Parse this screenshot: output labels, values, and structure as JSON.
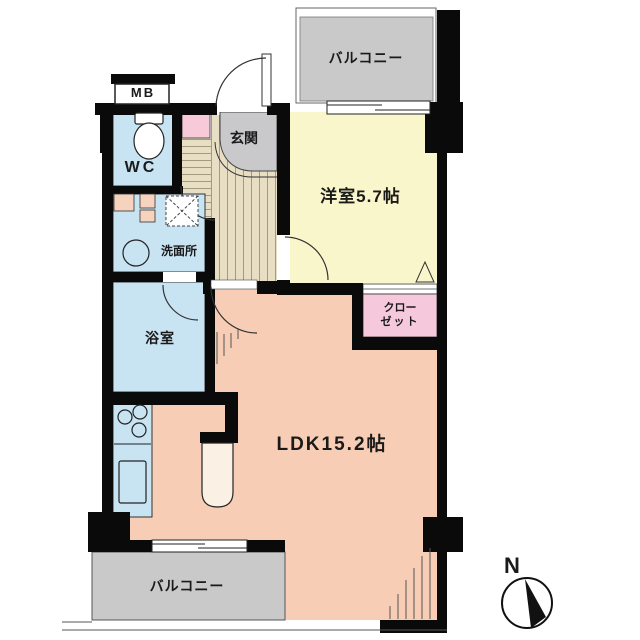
{
  "rooms": {
    "balcony_top": {
      "label": "バルコニー",
      "color": "#c9c9c9"
    },
    "western_room": {
      "label": "洋室5.7帖",
      "color": "#faf6cb"
    },
    "entrance": {
      "label": "玄関",
      "color": "#c9c9cc"
    },
    "meter_box": {
      "label": "MB",
      "color": "#ffffff"
    },
    "wc": {
      "label": "WC",
      "color": "#c8e3f2"
    },
    "washroom": {
      "label": "洗面所",
      "color": "#c8e3f2"
    },
    "bathroom": {
      "label": "浴室",
      "color": "#c8e3f2"
    },
    "kitchen": {
      "color": "#c8e3f2"
    },
    "closet": {
      "label_lines": [
        "クロー",
        "ゼット"
      ],
      "color": "#f5c9db"
    },
    "ldk": {
      "label": "LDK15.2帖",
      "color": "#f7cdb5"
    },
    "balcony_bottom": {
      "label": "バルコニー",
      "color": "#c9c9c9"
    },
    "hallway": {
      "color": "#e8dec4"
    }
  },
  "compass": {
    "label": "N"
  },
  "colors": {
    "wall": "#0a0a0a",
    "outline": "#333333",
    "counter": "#faf0e4"
  }
}
